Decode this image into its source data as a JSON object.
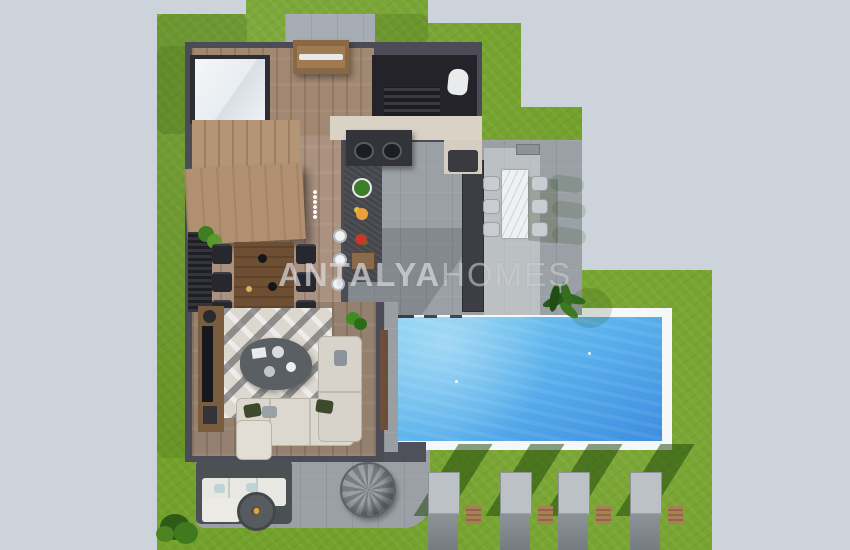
{
  "watermark": {
    "brand_bold": "ANTALYA",
    "brand_light": "HOMES"
  },
  "palette": {
    "background": "#cdd3db",
    "grass": "#73a12b",
    "building_wall": "#4c4c56",
    "wood_floor": "#a18872",
    "terrace_concrete": "#9aa0a5",
    "driveway": "#a6acb3",
    "pool_water_light": "#7ccdf1",
    "pool_water_deep": "#3d8ee0",
    "pool_border": "#f5f7f8",
    "lounger_cushion": "#bcc1c6"
  },
  "scene": {
    "view": "top-down villa floor plan render",
    "areas": [
      "driveway",
      "entrance-pergola",
      "skylight",
      "staircase",
      "wc",
      "outdoor-kitchen",
      "indoor-dining",
      "living-room",
      "dining-terrace",
      "pool",
      "outdoor-lounge",
      "garden"
    ],
    "garden": {
      "sun_lounger_count": 4,
      "side_table_count": 4,
      "dining_chair_count": 6,
      "terrace_chair_count": 6
    }
  }
}
